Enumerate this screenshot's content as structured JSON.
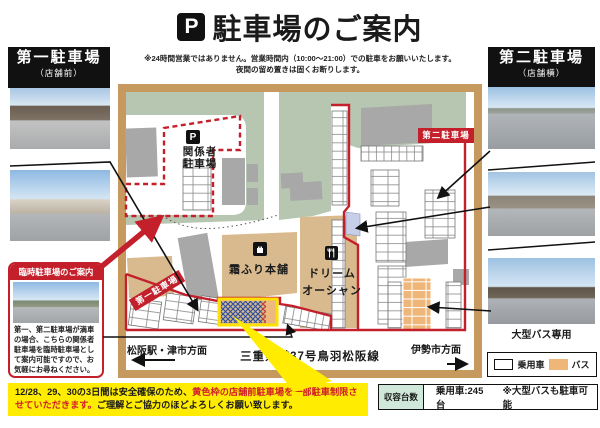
{
  "title": {
    "badge": "P",
    "text": "駐車場のご案内",
    "note1": "※24時間営業ではありません。営業時間内（10:00～21:00）での駐車をお願いいたします。",
    "note2": "夜間の留め置きは固くお断りします。"
  },
  "left": {
    "header": "第一駐車場",
    "sub": "（店舗前）"
  },
  "right": {
    "header": "第二駐車場",
    "sub": "（店舗横）",
    "bus_caption": "大型バス専用"
  },
  "temp": {
    "header": "臨時駐車場のご案内",
    "body": "第一、第二駐車場が満車の場合、こちらの関係者駐車場を臨時駐車場として案内可能ですので、お気軽にお尋ねください。"
  },
  "map": {
    "staff_badge": "P",
    "staff_line1": "関係者",
    "staff_line2": "駐車場",
    "lot1": "第一駐車場",
    "lot2": "第二駐車場",
    "store1": "霜ふり本舗",
    "store2a": "ドリーム",
    "store2b": "オーシャン",
    "dir_left": "松阪駅・津市方面",
    "road": "三重県道37号鳥羽松阪線",
    "dir_right": "伊勢市方面"
  },
  "legend": {
    "car": "乗用車",
    "bus": "バス"
  },
  "capacity": {
    "label": "収容台数",
    "value": "乗用車:245台",
    "note": "※大型バスも駐車可能"
  },
  "notice": {
    "p1": "12/28、29、30の3日間は安全確保のため、",
    "p2": "黄色枠の店舗前駐車場を一部駐車制限させていただきます。",
    "p3": "ご理解とご協力のほどよろしくお願い致します。"
  },
  "colors": {
    "red": "#c4202c",
    "map_green": "#b6c6b0",
    "road_frame": "#c69a5f",
    "building_tan": "#d8ba8e",
    "bus_orange": "#eeb679",
    "highlight_yellow": "#ffec00",
    "capacity_mint": "#cfe8d9"
  }
}
